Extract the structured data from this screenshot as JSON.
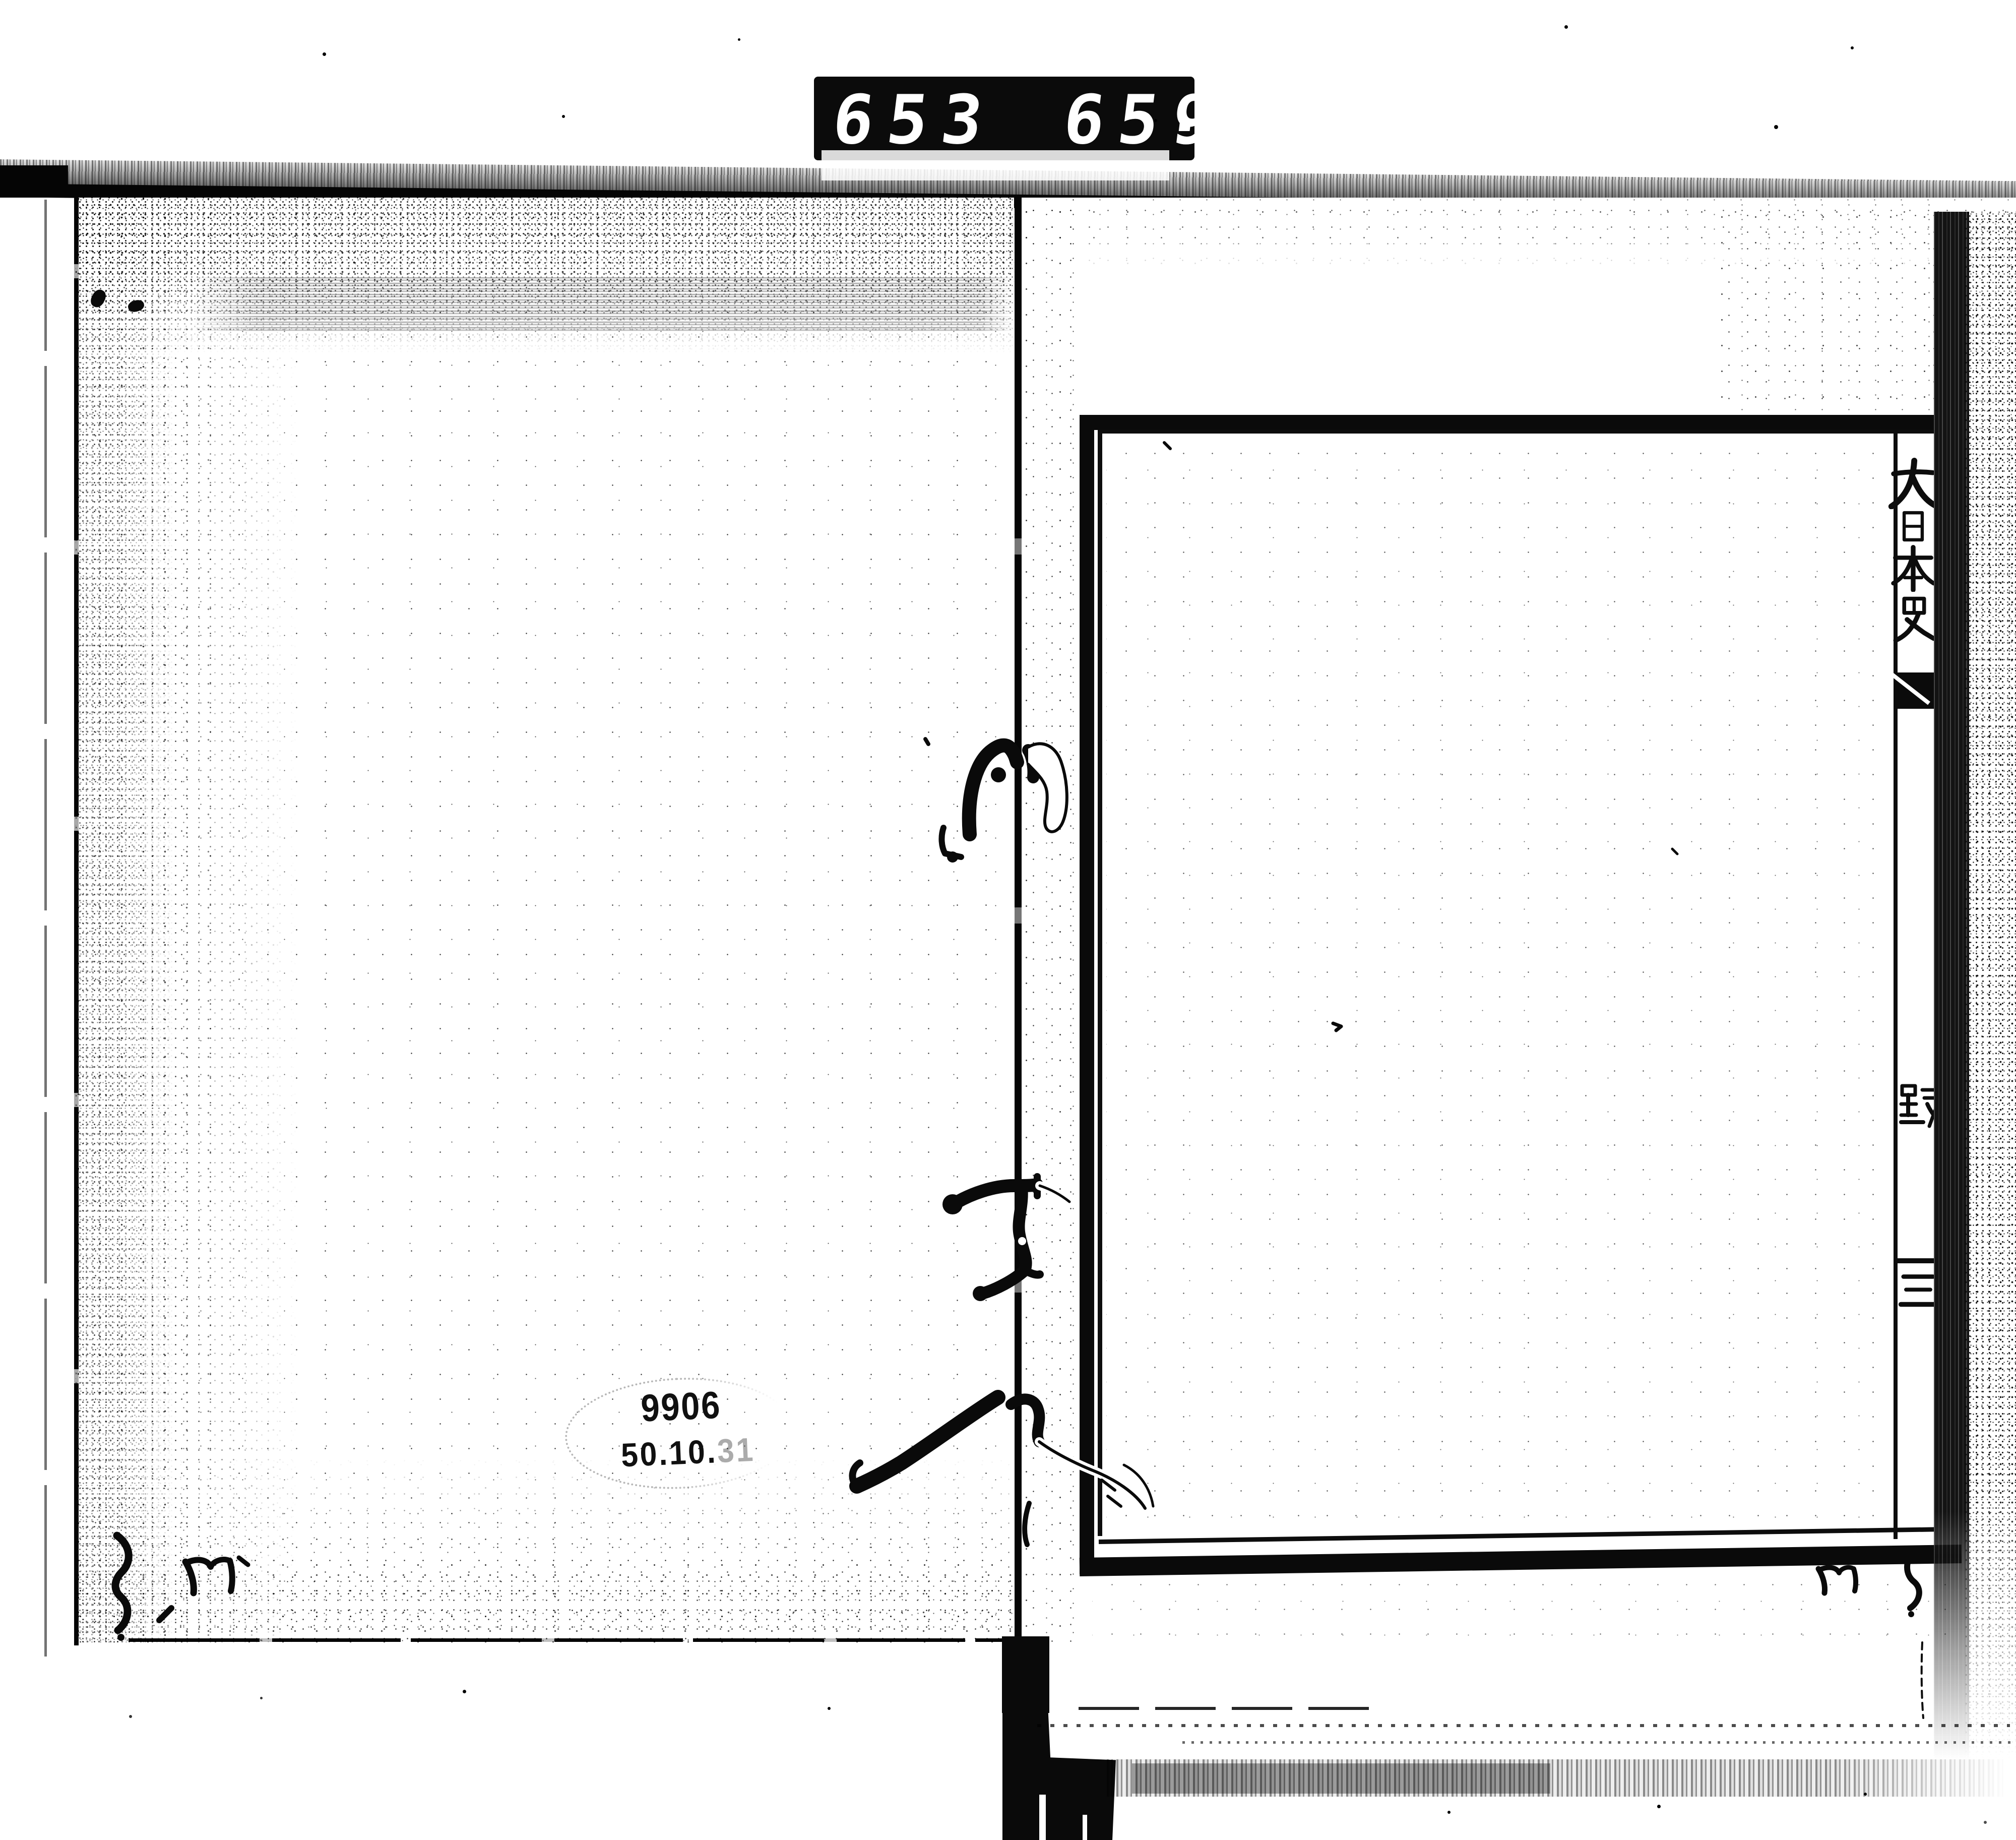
{
  "counter": {
    "left_value": "653",
    "right_value": "659",
    "decimal_point": "."
  },
  "left_page": {
    "stamp_number": "9906",
    "stamp_date_main": "50.10.",
    "stamp_date_faint": "31"
  },
  "right_page": {
    "title": "大日本史",
    "title_chars": [
      "大",
      "日",
      "本",
      "史"
    ],
    "partial_char_middle": "踐",
    "partial_char_lower": "三"
  },
  "colors": {
    "ink": "#0b0b0b",
    "paper": "#ffffff"
  }
}
